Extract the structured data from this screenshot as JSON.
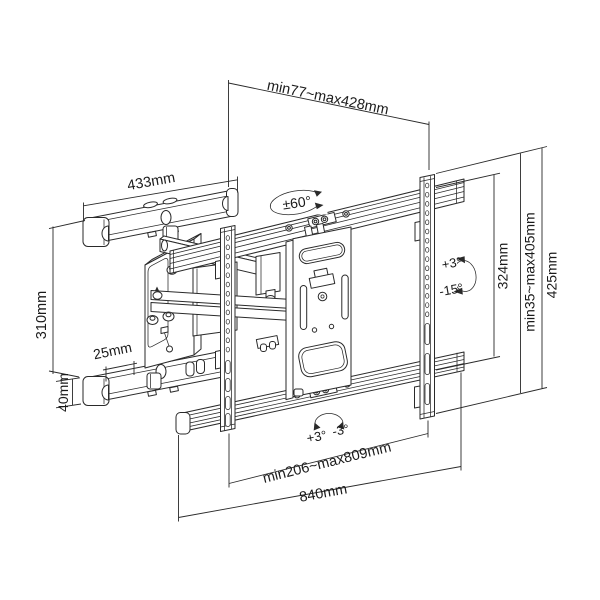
{
  "figure": {
    "type": "technical line drawing",
    "subject": "Articulating full-motion TV wall mount bracket with dimension callouts",
    "background_color": "#ffffff",
    "line_color": "#2a2a2a",
    "text_color": "#1a1a1a"
  },
  "dimensions": {
    "depth_range": "min77~max428mm",
    "wall_rail_length": "433mm",
    "wall_plate_height": "310mm",
    "rail_offset": "25mm",
    "rail_height": "40mm",
    "vesa_height": "324mm",
    "height_range": "min35~max405mm",
    "bracket_height": "425mm",
    "width_range": "min206~max809mm",
    "total_width": "840mm"
  },
  "angles": {
    "swivel": "±60°",
    "tilt_up": "+3°",
    "tilt_down": "-15°",
    "level_left": "+3°",
    "level_right": "-3°"
  }
}
